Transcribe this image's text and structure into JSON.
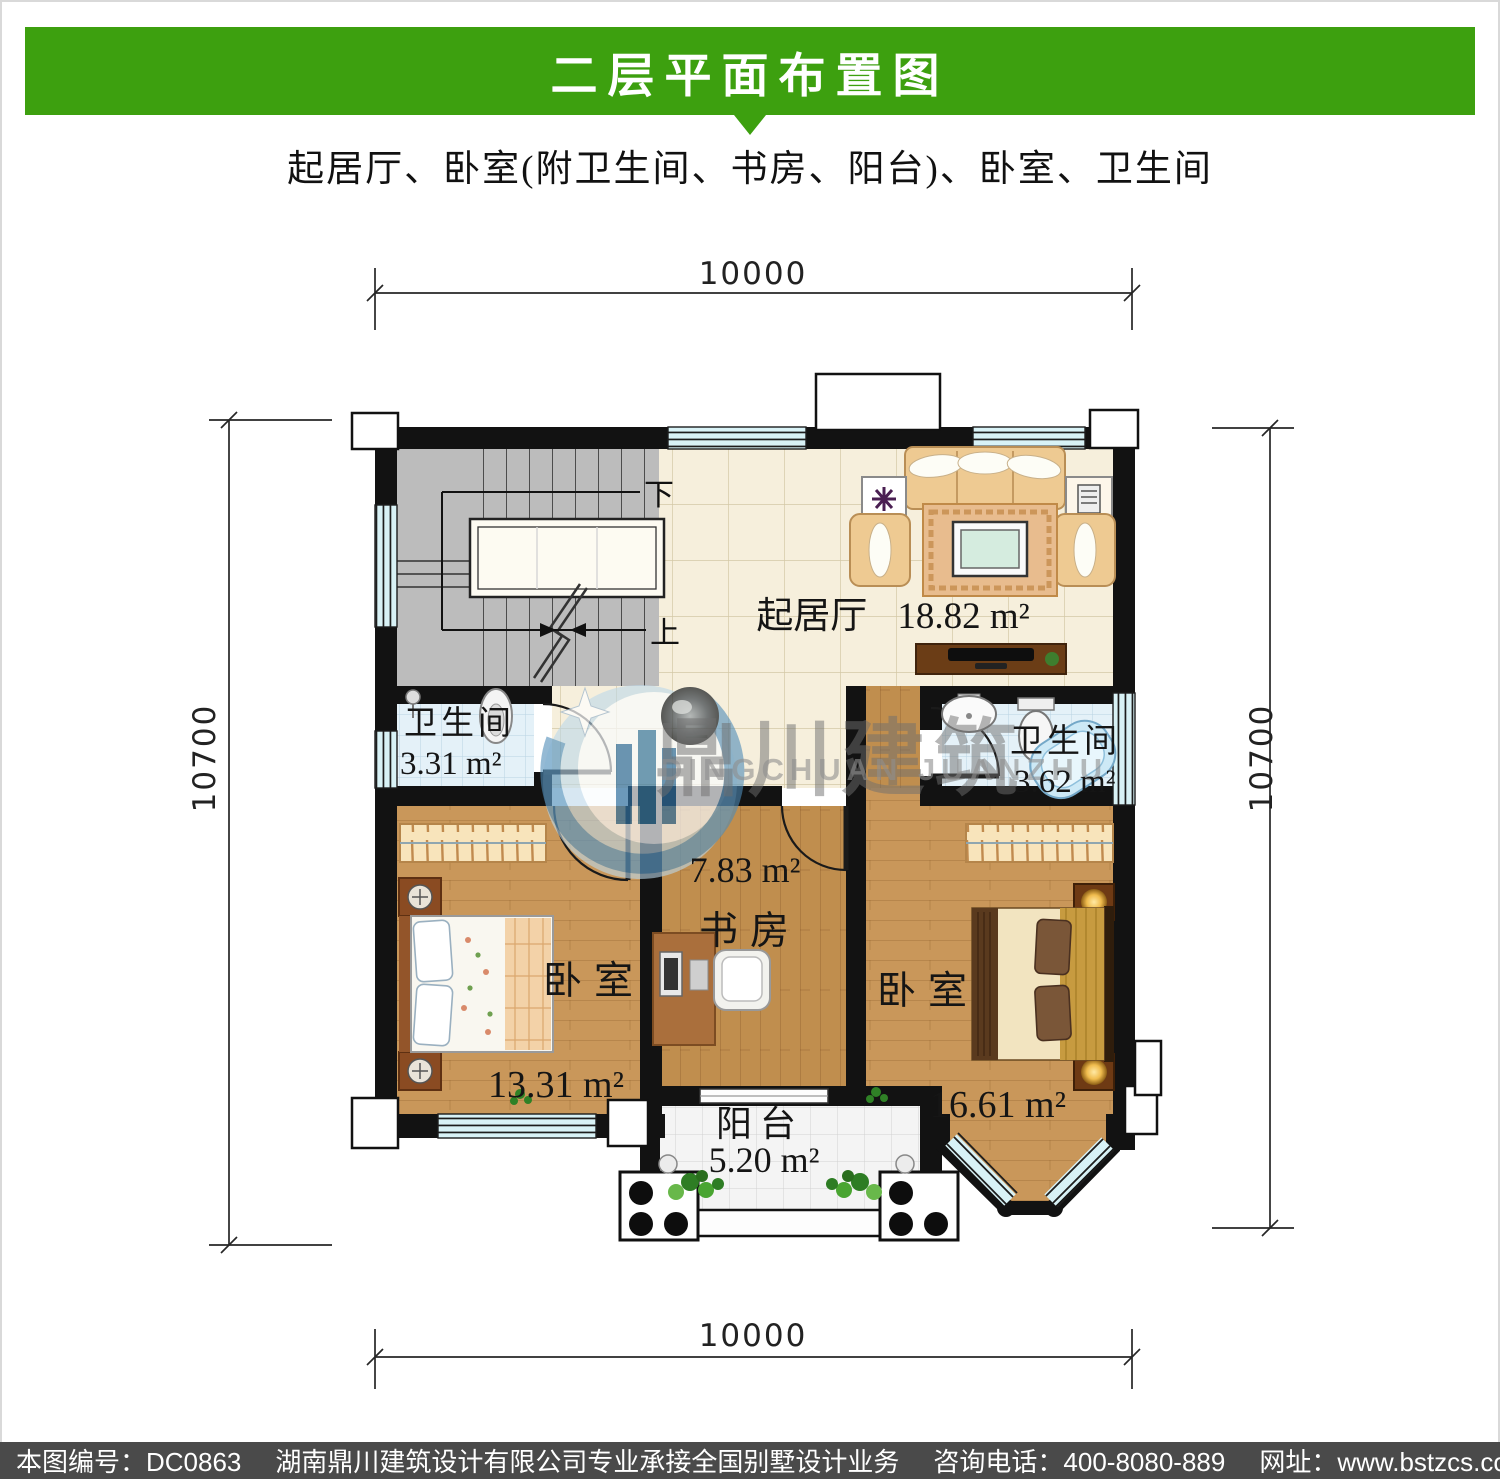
{
  "header": {
    "title": "二层平面布置图",
    "subtitle": "起居厅、卧室(附卫生间、书房、阳台)、卧室、卫生间",
    "bar_color": "#3da00f"
  },
  "footer": {
    "drawing_no": "本图编号：DC0863",
    "company": "湖南鼎川建筑设计有限公司专业承接全国别墅设计业务",
    "phone": "咨询电话：400-8080-889",
    "website": "网址：www.bstzcs.com"
  },
  "watermark": {
    "cn": "鼎川建筑",
    "en": "DINGCHUAN JUANZHU"
  },
  "dimensions": {
    "top": "10000",
    "bottom": "10000",
    "left": "10700",
    "right": "10700"
  },
  "stairs": {
    "down": "下",
    "up": "上"
  },
  "rooms": [
    {
      "id": "living",
      "name": "起居厅",
      "area": "18.82 m²"
    },
    {
      "id": "bath_left",
      "name": "卫生间",
      "area": "3.31 m²"
    },
    {
      "id": "bath_right",
      "name": "卫生间",
      "area": "3.62 m²"
    },
    {
      "id": "study",
      "name": "书房",
      "area": "7.83 m²"
    },
    {
      "id": "bedroom_left",
      "name": "卧室",
      "area": "13.31 m²"
    },
    {
      "id": "bedroom_right",
      "name": "卧室",
      "area": "16.61 m²"
    },
    {
      "id": "balcony",
      "name": "阳台",
      "area": "5.20 m²"
    }
  ]
}
